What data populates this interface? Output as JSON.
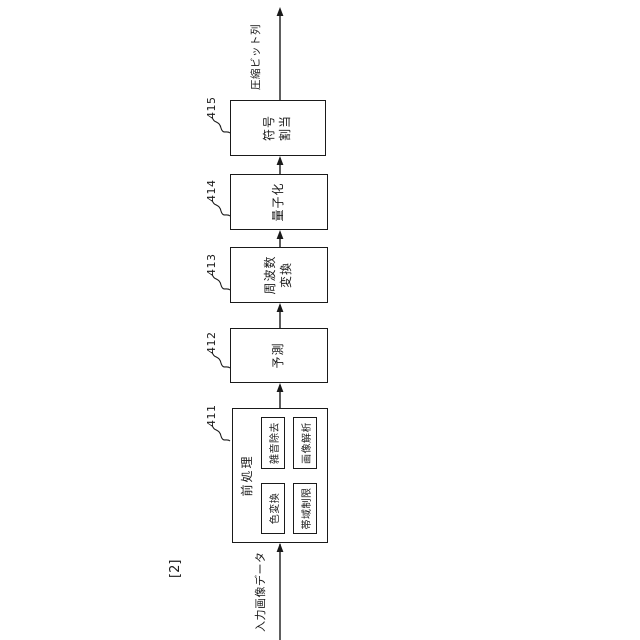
{
  "figure": {
    "label": "[2]",
    "input_label": "入力画像データ",
    "output_label": "圧縮ビット列",
    "blocks": [
      {
        "ref": "411",
        "title": "前処理",
        "children": [
          {
            "label": "色変換"
          },
          {
            "label": "雑音除去"
          },
          {
            "label": "帯域制限"
          },
          {
            "label": "画像解析"
          }
        ]
      },
      {
        "ref": "412",
        "label": "予測"
      },
      {
        "ref": "413",
        "label": "周波数変換",
        "lines": [
          "周波数",
          "変換"
        ]
      },
      {
        "ref": "414",
        "label": "量子化"
      },
      {
        "ref": "415",
        "label": "符号割当",
        "lines": [
          "符号",
          "割当"
        ]
      }
    ],
    "colors": {
      "line": "#1a1a1a",
      "background": "#ffffff"
    }
  }
}
